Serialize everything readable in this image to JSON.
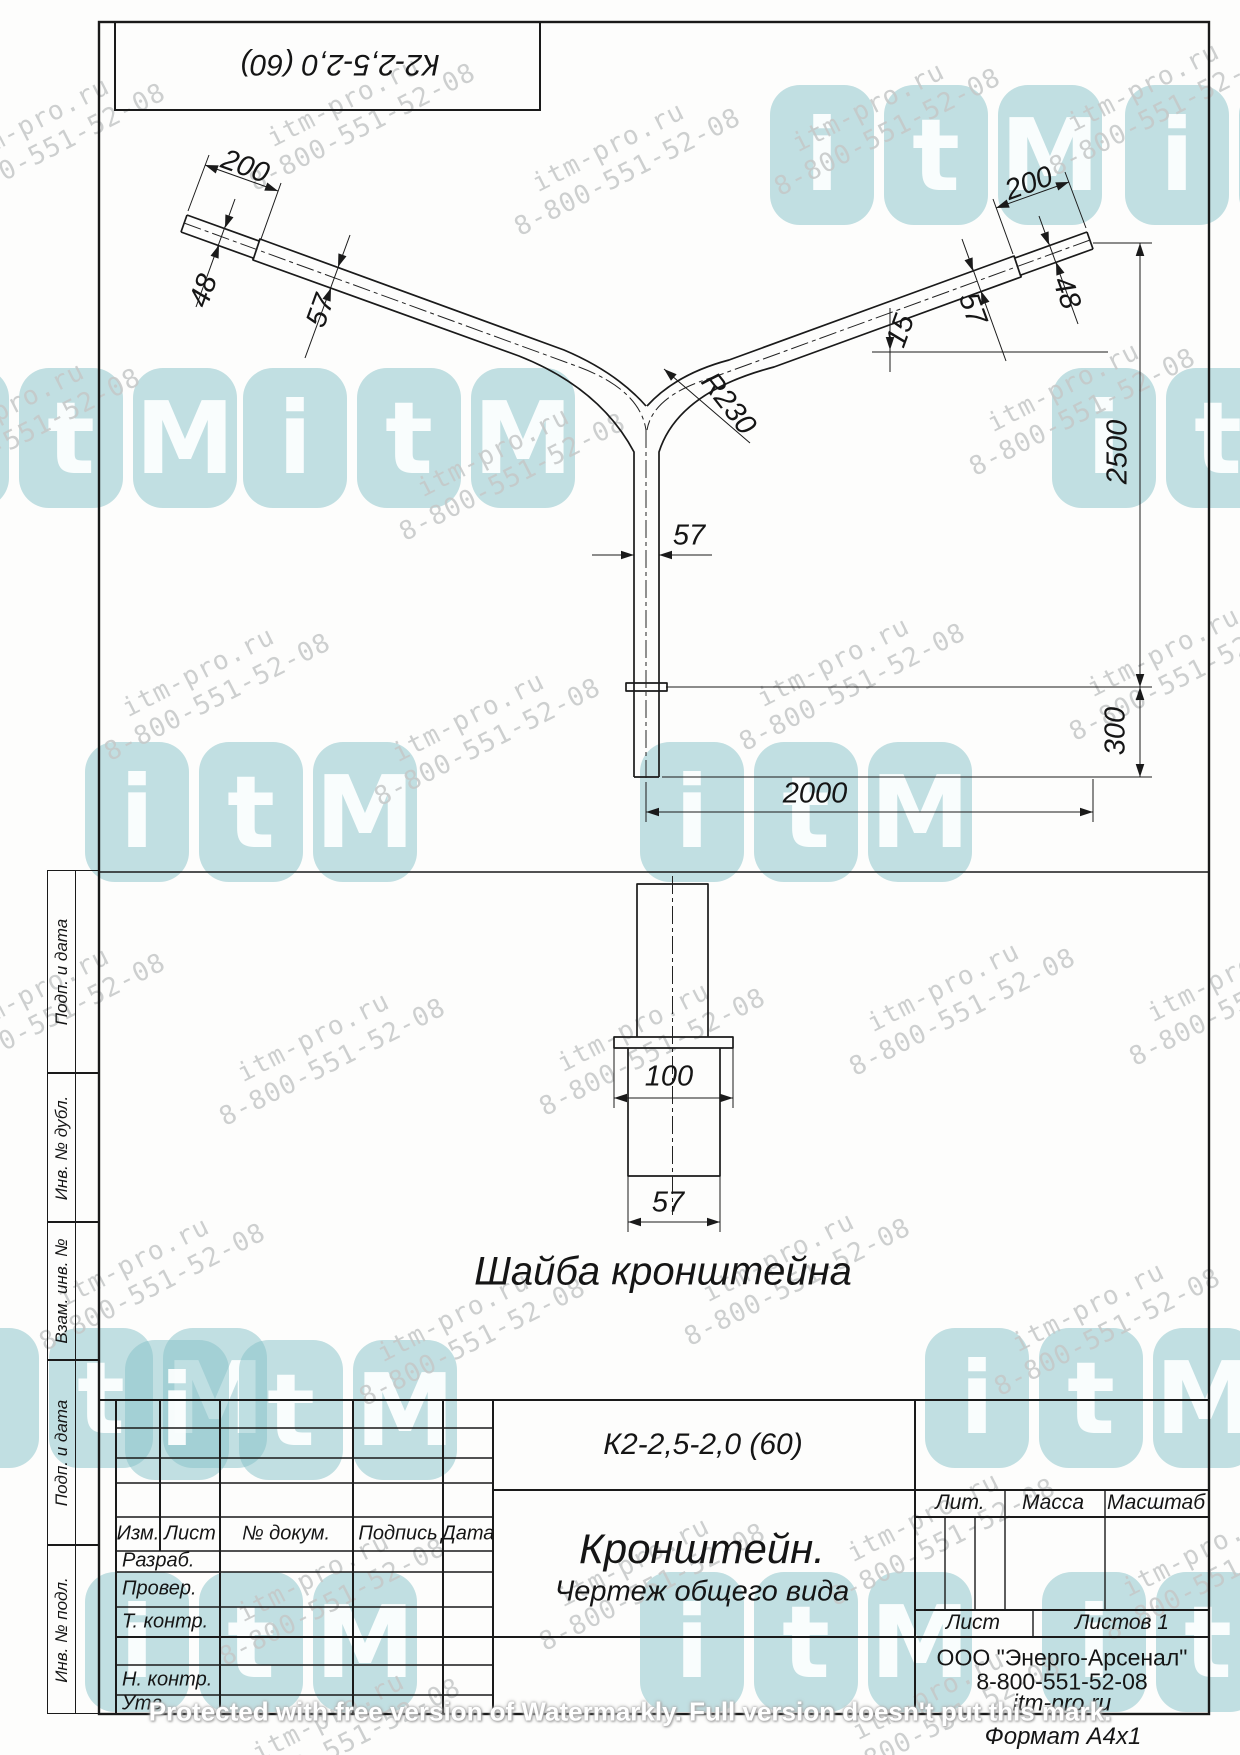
{
  "stamp": {
    "code": "К2-2,5-2,0 (60)"
  },
  "watermark": {
    "line1": "itm-pro.ru",
    "line2": "8-800-551-52-08",
    "logo_letters": [
      "i",
      "t",
      "M"
    ],
    "protected_note": "Protected with free version of Watermarkly. Full version doesn't put this mark."
  },
  "drawing": {
    "dim_left_200": "200",
    "dim_left_48": "48",
    "dim_left_57": "57",
    "dim_right_200": "200",
    "dim_right_48": "48",
    "dim_right_57": "57",
    "dim_angle": "15",
    "dim_radius": "R230",
    "dim_mast": "57",
    "dim_height": "2500",
    "dim_base": "300",
    "dim_span": "2000",
    "washer_dim_flange": "100",
    "washer_dim_pipe": "57",
    "washer_caption": "Шайба кронштейна"
  },
  "sidebar": {
    "items": [
      {
        "label": "Подп. и дата"
      },
      {
        "label": "Инв. № дубл."
      },
      {
        "label": "Взам. инв. №"
      },
      {
        "label": "Подп. и дата"
      },
      {
        "label": "Инв. № подл."
      }
    ]
  },
  "titleblock": {
    "doc_number": "К2-2,5-2,0 (60)",
    "title": "Кронштейн.",
    "subtitle": "Чертеж общего вида",
    "cols": {
      "izm": "Изм.",
      "list": "Лист",
      "doc": "№ докум.",
      "podpis": "Подпись",
      "data": "Дата"
    },
    "rows": {
      "razrab": "Разраб.",
      "prover": "Провер.",
      "tkontr": "Т. контр.",
      "nkontr": "Н. контр.",
      "utv": "Утв."
    },
    "lit": "Лит.",
    "mass": "Масса",
    "scale": "Масштаб",
    "sheet": "Лист",
    "sheets": "Листов 1",
    "company_line1": "ООО \"Энерго-Арсенал\"",
    "company_line2": "8-800-551-52-08",
    "company_line3": "itm-pro.ru",
    "format": "Формат  А4х1"
  }
}
